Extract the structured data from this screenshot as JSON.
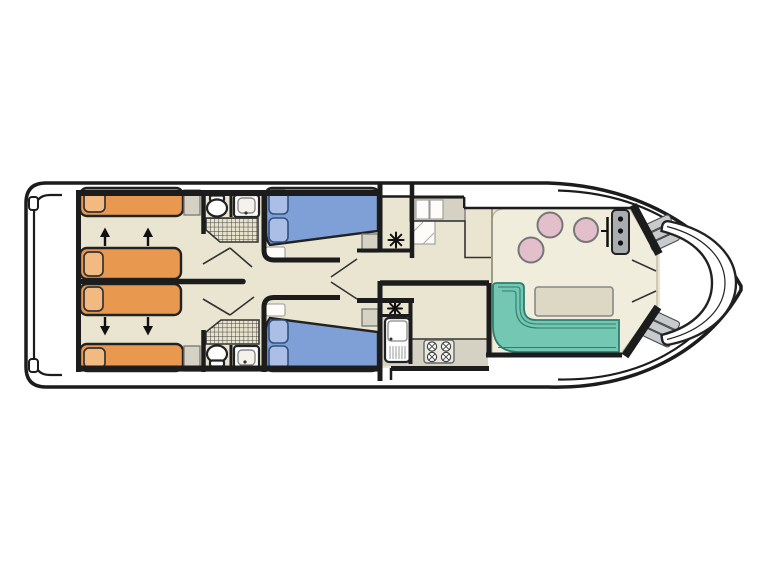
{
  "page": {
    "background": "#ffffff"
  },
  "palette": {
    "hull-line": "#1c1c1c",
    "wall": "#1c1c1c",
    "floor": "#e9e5d0",
    "floor-raised": "#f0eddd",
    "counter": "#d5d2c3",
    "bed-orange": "#e9994f",
    "pillow-orange": "#f2ba80",
    "bed-blue": "#7f9fd7",
    "pillow-blue": "#abbfe6",
    "bench-teal": "#74c7b2",
    "bench-teal-edge": "#2f7d6e",
    "stool-pink": "#e2bfcb",
    "console-gray": "#a9adb0",
    "steps-gray": "#c7cbcd",
    "table": "#dcd8c4",
    "fixture": "#ffffff"
  },
  "plan": {
    "type": "boat-deck-floorplan",
    "orientation": "bow-right-stern-left",
    "areas": [
      {
        "id": "stern-swim-platform"
      },
      {
        "id": "aft-cabin-port",
        "beds": [
          "single-orange",
          "double-orange"
        ]
      },
      {
        "id": "aft-cabin-starboard",
        "beds": [
          "single-orange",
          "double-orange"
        ]
      },
      {
        "id": "bathroom-port",
        "fixtures": [
          "toilet",
          "sink",
          "shower"
        ]
      },
      {
        "id": "bathroom-starboard",
        "fixtures": [
          "toilet",
          "sink",
          "shower"
        ]
      },
      {
        "id": "mid-cabin-port",
        "beds": [
          "double-blue"
        ]
      },
      {
        "id": "mid-cabin-starboard",
        "beds": [
          "double-blue"
        ]
      },
      {
        "id": "corridor"
      },
      {
        "id": "galley",
        "fixtures": [
          "sink-drainer",
          "stove-4-burners",
          "cabinets"
        ]
      },
      {
        "id": "saloon-dinette",
        "fixtures": [
          "l-shaped-bench",
          "table",
          "three-stools"
        ]
      },
      {
        "id": "helm-station",
        "fixtures": [
          "console-3-instruments",
          "throttle-lever"
        ]
      },
      {
        "id": "bow-cockpit",
        "fixtures": [
          "curved-bench",
          "steps-port",
          "steps-starboard"
        ]
      }
    ],
    "furniture_counts": {
      "orange-single-beds": 2,
      "orange-double-beds": 2,
      "blue-double-beds": 2,
      "bathrooms": 2,
      "dinette-stools": 3,
      "stove-burners": 4,
      "heater-symbols": 2,
      "bed-convert-arrows": 4
    },
    "symbols": [
      {
        "id": "heater-icon",
        "glyph": "✳"
      },
      {
        "id": "shower-icon",
        "style": "crosshatch-grid"
      },
      {
        "id": "bed-convert-arrow-icon",
        "glyph": "↑↓"
      }
    ]
  }
}
